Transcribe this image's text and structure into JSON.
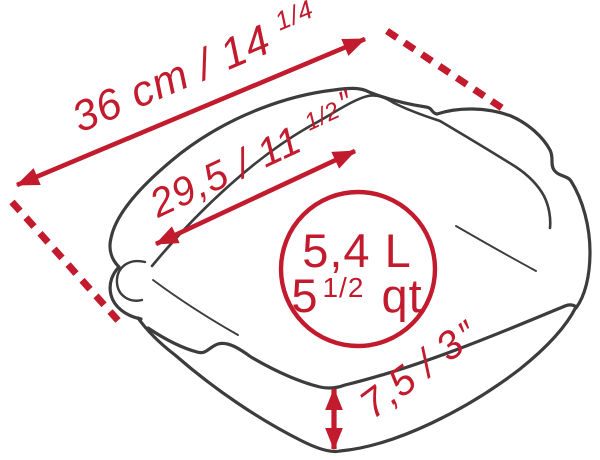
{
  "dimensions": {
    "outer": {
      "main": "36 cm / 14 ",
      "fraction": "1/4",
      "mark": "″"
    },
    "inner": {
      "main": "29,5 / 11 ",
      "fraction": "1/2",
      "mark": "″"
    },
    "height": {
      "main": "7,5 / 3",
      "mark": "″"
    }
  },
  "capacity": {
    "liters": "5,4 L",
    "quarts_whole": "5",
    "quarts_fraction": "1/2",
    "quarts_unit": " qt"
  },
  "colors": {
    "accent_red": "#c21b2e",
    "line_gray": "#3c3c3c",
    "background": "#ffffff"
  }
}
